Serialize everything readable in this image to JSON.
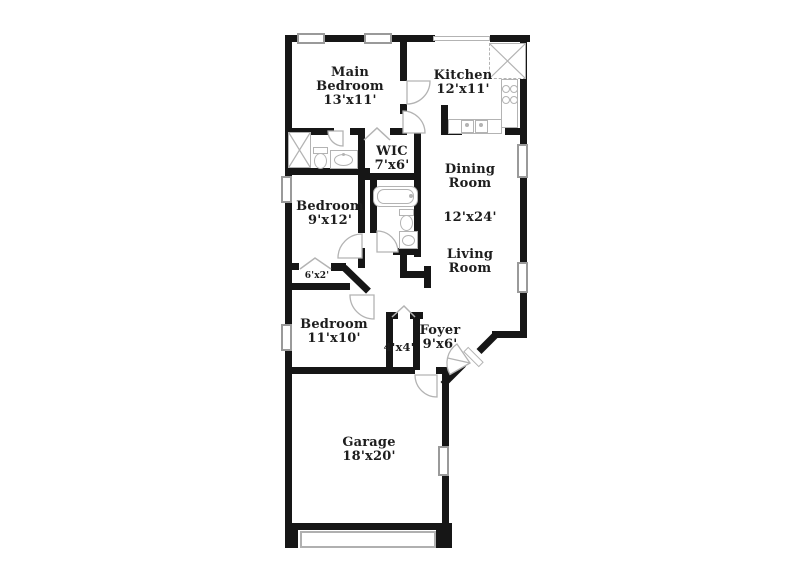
{
  "rooms": {
    "main_bedroom": {
      "line1": "Main",
      "line2": "Bedroom",
      "dim": "13'x11'"
    },
    "kitchen": {
      "name": "Kitchen",
      "dim": "12'x11'"
    },
    "wic": {
      "name": "WIC",
      "dim": "7'x6'"
    },
    "dining_room": {
      "line1": "Dining",
      "line2": "Room"
    },
    "dining_living_dim": "12'x24'",
    "living_room": {
      "line1": "Living",
      "line2": "Room"
    },
    "bedroom_2": {
      "name": "Bedroom",
      "dim": "9'x12'"
    },
    "hall_closet_dim": "6'x2'",
    "bedroom_3": {
      "name": "Bedroom",
      "dim": "11'x10'"
    },
    "foyer_closet_dim": "4'x4'",
    "foyer": {
      "name": "Foyer",
      "dim": "9'x6'"
    },
    "garage": {
      "name": "Garage",
      "dim": "18'x20'"
    }
  },
  "fixtures": [
    "shower",
    "toilet",
    "vanity-sink",
    "bathtub",
    "kitchen-sink",
    "stove",
    "pantry",
    "garage-door"
  ],
  "colors": {
    "wall": "#161616",
    "fixture_line": "#b3b3b3",
    "window_border": "#9a9a9a",
    "text": "#1d1d1d",
    "background": "#ffffff"
  }
}
